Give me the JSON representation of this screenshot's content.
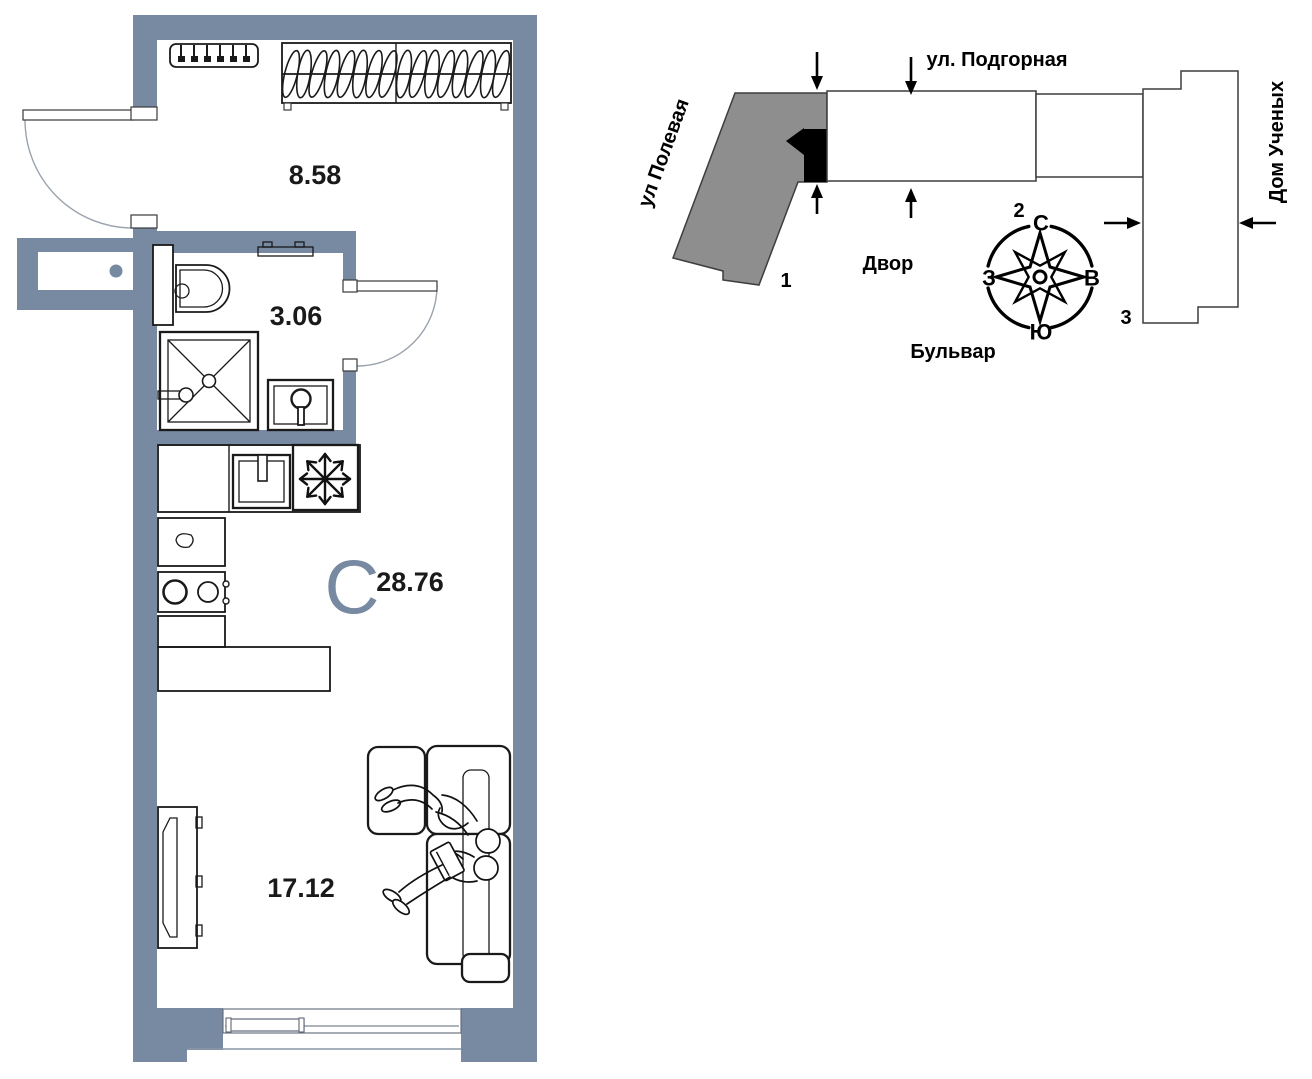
{
  "floor_plan": {
    "hall_area": "8.58",
    "bathroom_area": "3.06",
    "living_area": "17.12",
    "type_letter": "С",
    "total_area": "28.76"
  },
  "site_plan": {
    "street_top": "ул. Подгорная",
    "street_left": "ул Полевая",
    "label_right": "Дом Ученых",
    "label_courtyard": "Двор",
    "label_boulevard": "Бульвар",
    "building_1": "1",
    "building_2": "2",
    "building_3": "3",
    "compass": {
      "n": "С",
      "e": "В",
      "s": "Ю",
      "w": "З"
    }
  },
  "colors": {
    "wall": "#7889a2",
    "accent": "#7889a2",
    "building_gray": "#8e8e8e",
    "marker_black": "#000000"
  }
}
